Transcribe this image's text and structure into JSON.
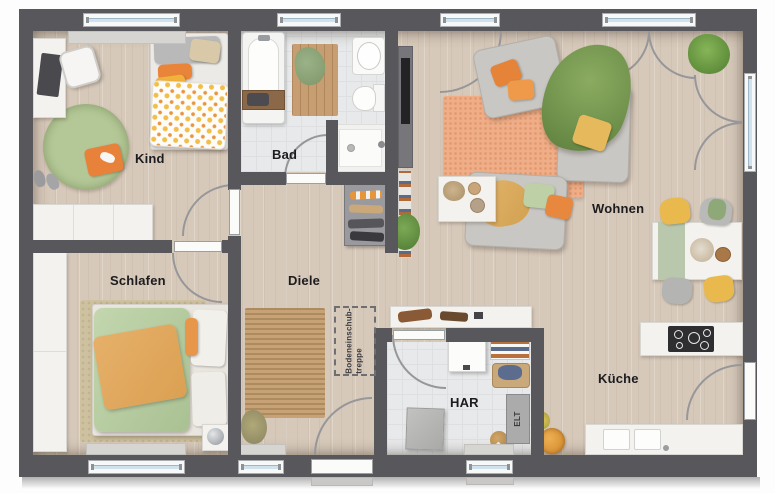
{
  "floorplan": {
    "type": "apartment-floorplan",
    "rooms": {
      "kind": {
        "label": "Kind"
      },
      "bad": {
        "label": "Bad"
      },
      "wohnen": {
        "label": "Wohnen"
      },
      "schlafen": {
        "label": "Schlafen"
      },
      "diele": {
        "label": "Diele"
      },
      "har": {
        "label": "HAR"
      },
      "kueche": {
        "label": "Küche"
      }
    },
    "annotations": {
      "loft_ladder_line1": "Bodeneinschub-",
      "loft_ladder_line2": "treppe",
      "electrical": "ELT"
    },
    "colors": {
      "wall": "#58585c",
      "wood_floor": "#d7c9ba",
      "tile_floor": "#e8e9ea",
      "window_glass": "#cfe2ee",
      "accent_orange": "#e8873c",
      "accent_green": "#a9c18c",
      "accent_yellow": "#e9b94e"
    }
  }
}
